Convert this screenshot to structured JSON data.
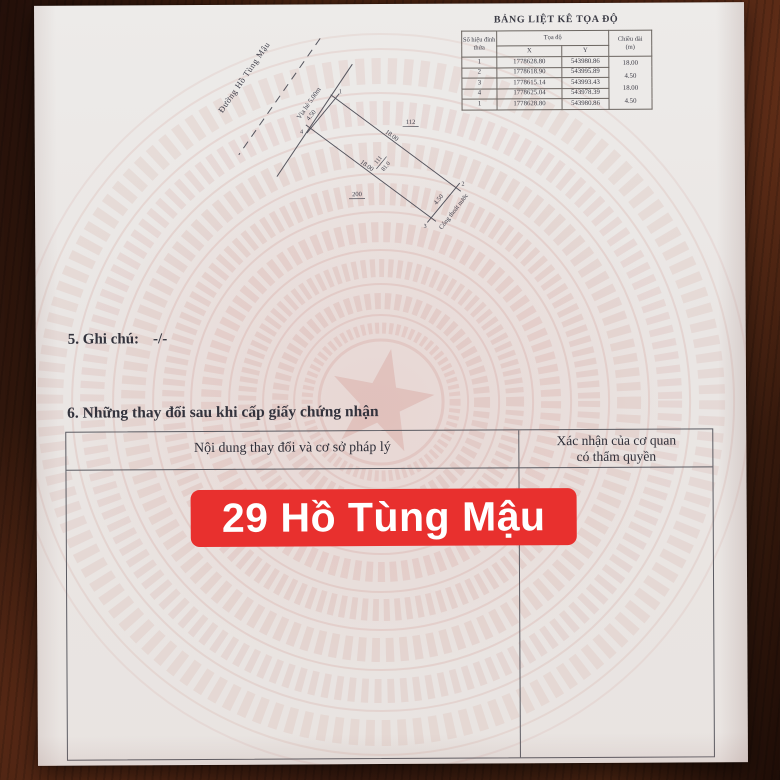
{
  "banner": {
    "text": "29 Hồ Tùng Mậu"
  },
  "coordinate_table": {
    "title": "BẢNG LIỆT KÊ TỌA ĐỘ",
    "header": {
      "vertex": "Số hiệu đỉnh thửa",
      "coords": "Tọa độ",
      "x": "X",
      "y": "Y",
      "length_line1": "Chiều dài",
      "length_line2": "(m)"
    },
    "rows": [
      {
        "id": "1",
        "x": "1778628.80",
        "y": "543980.86"
      },
      {
        "id": "2",
        "x": "1778618.90",
        "y": "543995.89"
      },
      {
        "id": "3",
        "x": "1778615.14",
        "y": "543993.43"
      },
      {
        "id": "4",
        "x": "1778625.04",
        "y": "543978.39"
      },
      {
        "id": "1",
        "x": "1778628.80",
        "y": "543980.86"
      }
    ],
    "lengths": [
      "18.00",
      "4.50",
      "18.00",
      "4.50"
    ]
  },
  "diagram": {
    "street": "Đường Hồ Tùng Mậu",
    "sidewalk": "Vỉa hè 5.00m",
    "drain": "Cống thoát nước",
    "front_length": "4.50",
    "back_length": "4.50",
    "side_length_top": "18.00",
    "side_length_bottom": "18.00",
    "parcel_number": "111",
    "parcel_area": "81.0",
    "neighbor_parcel_right": "112",
    "neighbor_parcel_left": "200",
    "vertices": [
      "1",
      "2",
      "3",
      "4"
    ]
  },
  "sections": {
    "note_label": "5. Ghi chú:",
    "note_value": "-/-",
    "changes_heading": "6. Những thay đổi sau khi cấp giấy chứng nhận"
  },
  "changes_table": {
    "col_content": "Nội dung thay đổi và cơ sở pháp lý",
    "col_confirm_line1": "Xác nhận của cơ quan",
    "col_confirm_line2": "có thẩm quyền"
  },
  "colors": {
    "banner_red": "#e8302e",
    "paper": "#eae6e4",
    "wood": "#2d150c"
  }
}
